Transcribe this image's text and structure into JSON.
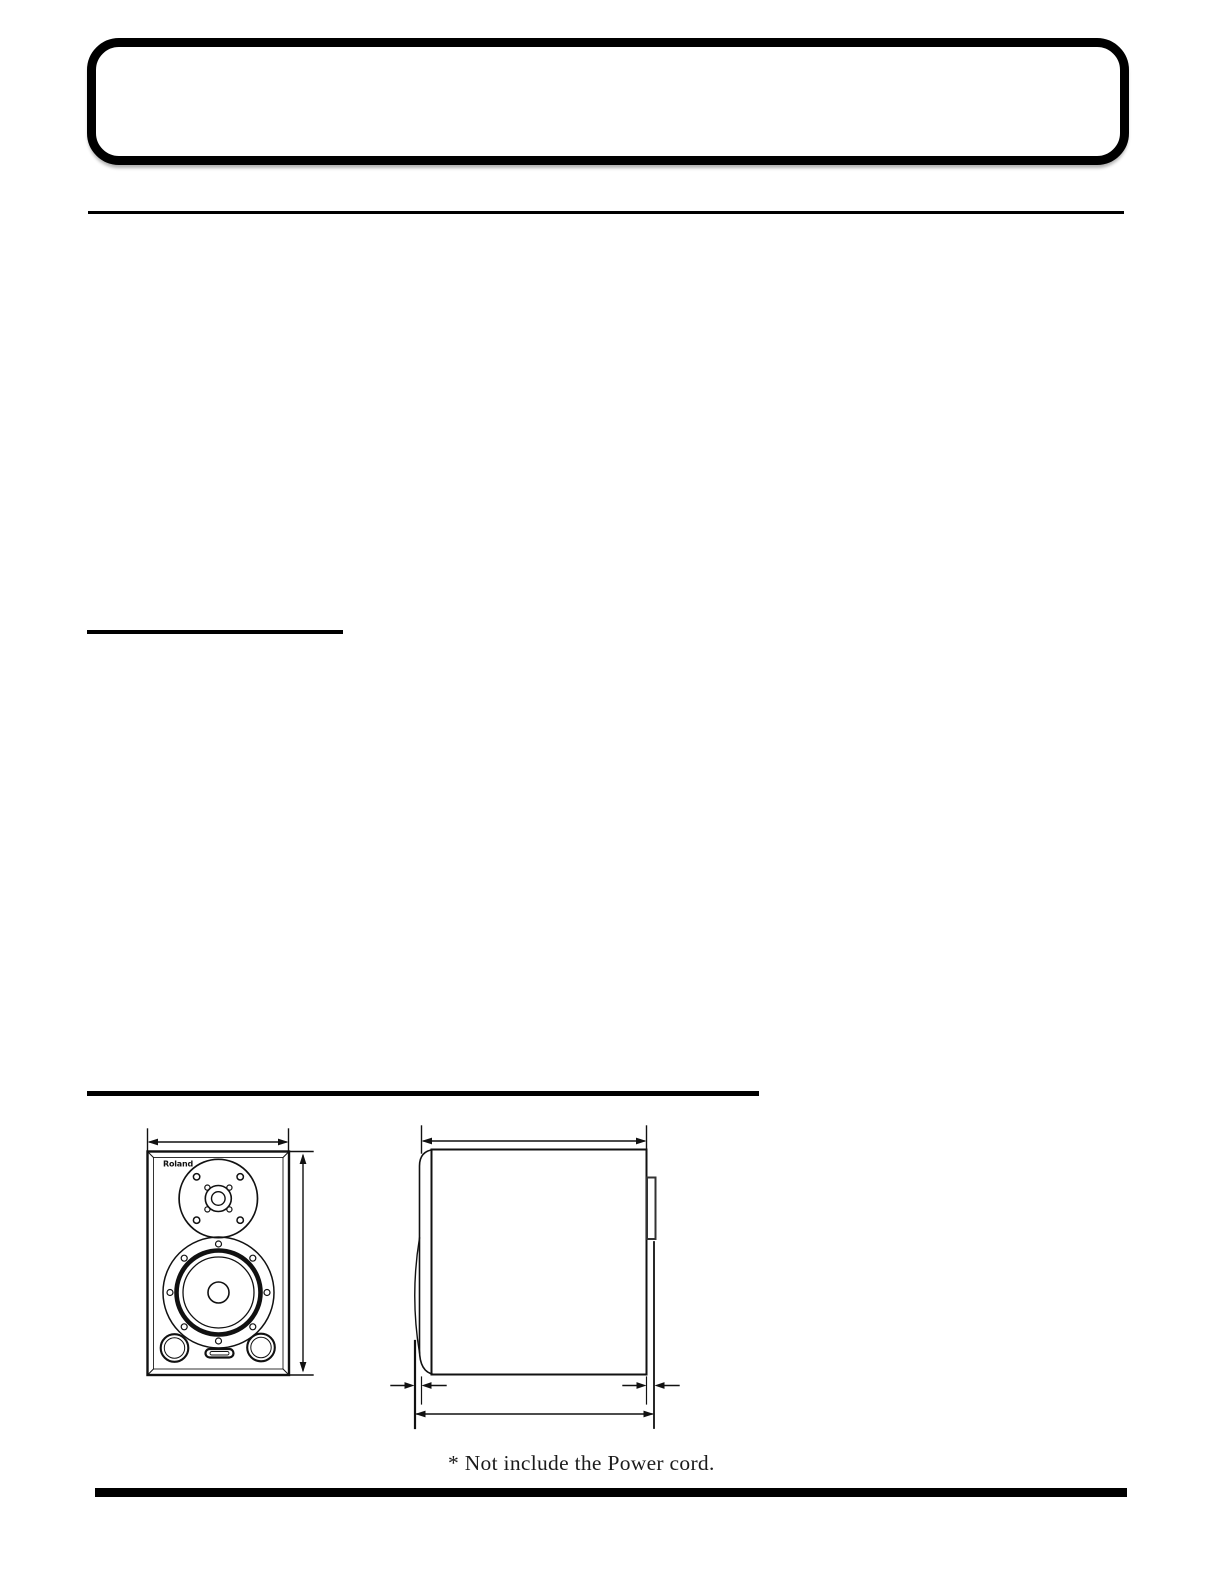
{
  "page": {
    "background": "#ffffff",
    "ink_color": "#000000",
    "line_color": "#111111"
  },
  "diagram": {
    "type": "speaker-dimension-drawing",
    "views": [
      "front-view",
      "side-view"
    ],
    "brand_logo": "Roland",
    "footnote": "* Not include the Power cord."
  }
}
